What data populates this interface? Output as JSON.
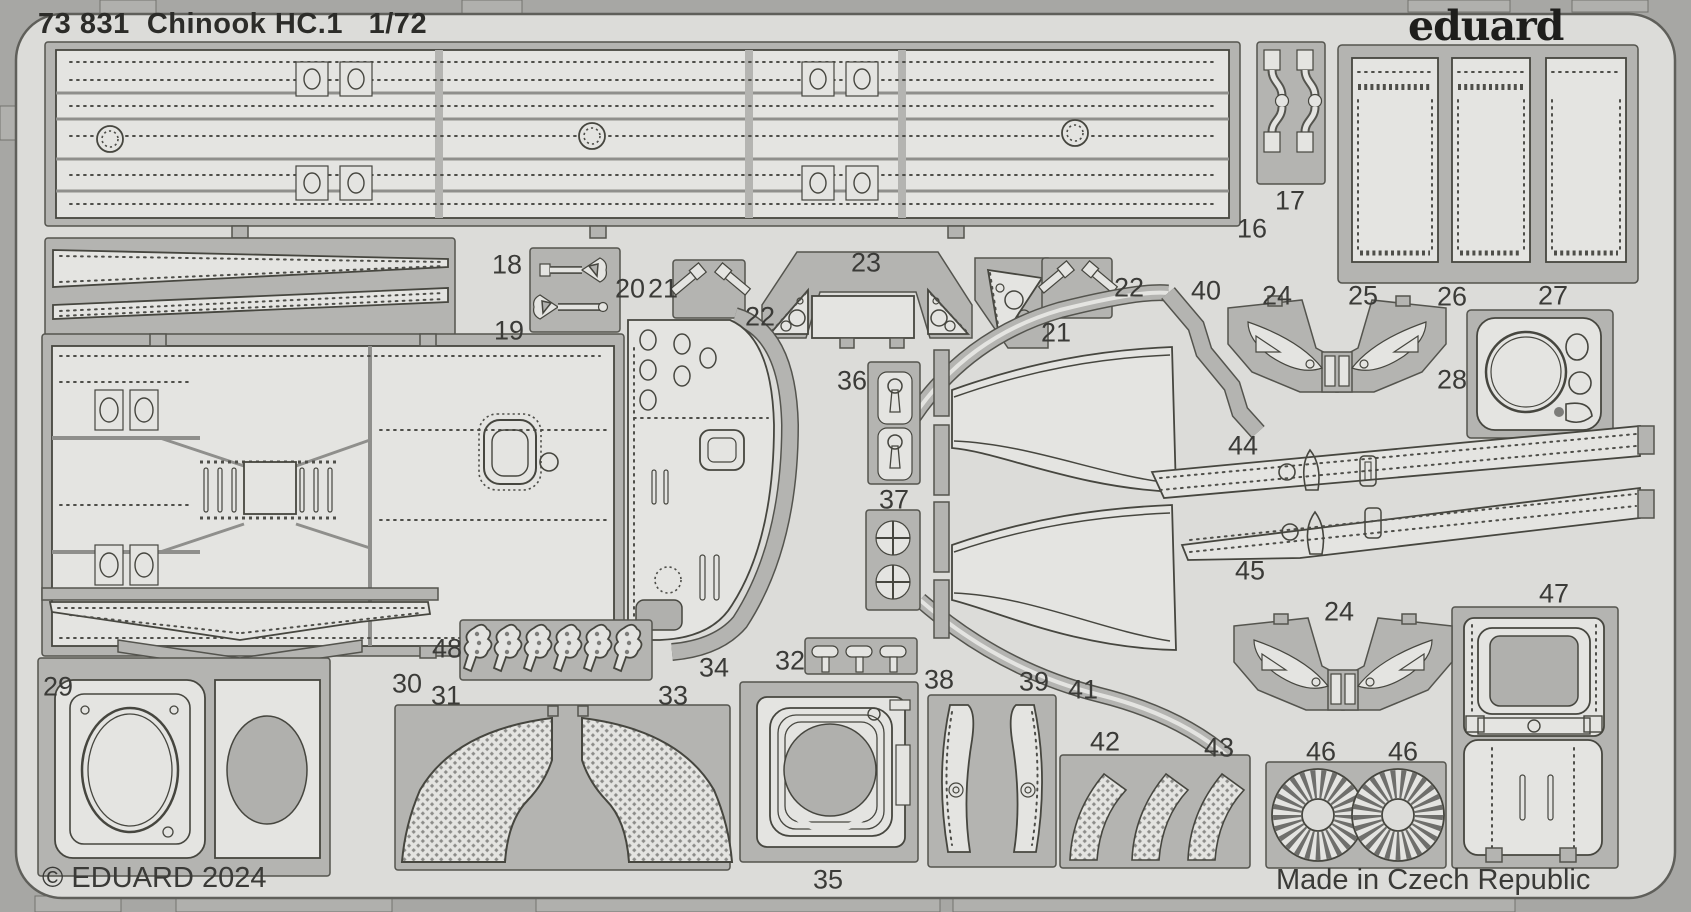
{
  "header": {
    "catalog_number": "73 831",
    "kit_name": "Chinook HC.1",
    "scale": "1/72",
    "brand": "eduard"
  },
  "footer": {
    "copyright": "© EDUARD 2024",
    "made_in": "Made in Czech Republic"
  },
  "colors": {
    "plate": "#dcdcd9",
    "sprue_frame": "#b4b4b1",
    "part_fill": "#e4e4e1",
    "outline": "#46463f",
    "margin": "#a7a7a4",
    "text": "#2c2c29"
  },
  "part_labels": {
    "p16": "16",
    "p17": "17",
    "p18": "18",
    "p19": "19",
    "p20": "20",
    "p21a": "21",
    "p21b": "21",
    "p22a": "22",
    "p22b": "22",
    "p23": "23",
    "p24a": "24",
    "p24b": "24",
    "p25": "25",
    "p26": "26",
    "p27": "27",
    "p28": "28",
    "p29": "29",
    "p30": "30",
    "p31": "31",
    "p32": "32",
    "p33": "33",
    "p34": "34",
    "p35": "35",
    "p36": "36",
    "p37": "37",
    "p38": "38",
    "p39": "39",
    "p40": "40",
    "p41": "41",
    "p42": "42",
    "p43": "43",
    "p44": "44",
    "p45": "45",
    "p46a": "46",
    "p46b": "46",
    "p47": "47",
    "p48": "48"
  }
}
